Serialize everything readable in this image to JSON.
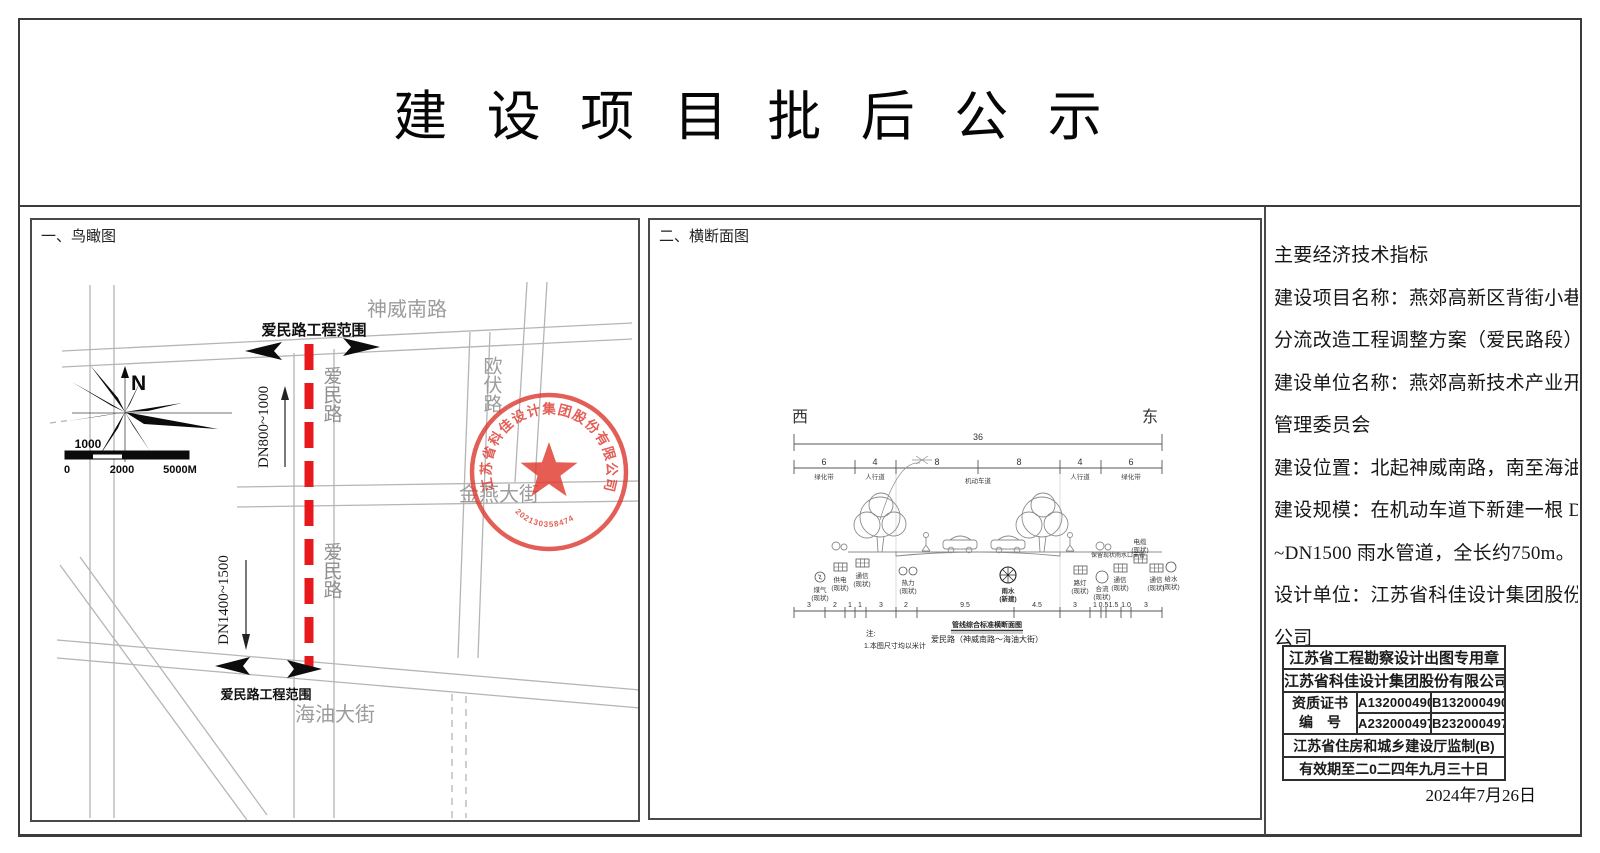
{
  "title": "建 设 项 目 批 后 公 示",
  "left_panel": {
    "heading": "一、鸟瞰图",
    "north": "N",
    "scale_top": "1000",
    "scale_0": "0",
    "scale_2000": "2000",
    "scale_5000": "5000M",
    "road_shenwei": "神威南路",
    "road_oufu": "欧伏路",
    "road_jinyan": "金燕大街",
    "road_haiyou": "海油大街",
    "road_aimin_north": "爱民路",
    "road_aimin_south": "爱民路",
    "scope_top": "爱民路工程范围",
    "scope_bottom": "爱民路工程范围",
    "pipe_north": "DN800~1000",
    "pipe_south": "DN1400~1500",
    "stamp_company": "江苏省科佳设计集团股份有限公司",
    "stamp_number": "202130358474"
  },
  "middle_panel": {
    "heading": "二、横断面图",
    "west": "西",
    "east": "东",
    "total": "36",
    "seg_dims": [
      "6",
      "4",
      "8",
      "8",
      "4",
      "6"
    ],
    "seg_labels": [
      "绿化带",
      "人行道",
      "机动车道",
      "人行道",
      "绿化带"
    ],
    "bottom_dims": [
      "3",
      "2",
      "1",
      "1",
      "3",
      "2",
      "9.5",
      "4.5",
      "3",
      "1",
      "0.5",
      "1.5",
      "1.0",
      "3"
    ],
    "utilities": [
      {
        "name": "煤气",
        "status": "(现状)"
      },
      {
        "name": "供电",
        "status": "(现状)"
      },
      {
        "name": "通信",
        "status": "(现状)"
      },
      {
        "name": "热力",
        "status": "(现状)"
      },
      {
        "name": "雨水",
        "status": "(新建)"
      },
      {
        "name": "路灯",
        "status": "(现状)"
      },
      {
        "name": "合流",
        "status": "(现状)"
      },
      {
        "name": "通信",
        "status": "(现状)"
      },
      {
        "name": "电缆",
        "status": "(现状)"
      },
      {
        "name": "通信",
        "status": "(现状)"
      },
      {
        "name": "给水",
        "status": "(现状)"
      }
    ],
    "keep_note": "保留现状雨水口支管",
    "caption_1": "管线综合标准横断面图",
    "caption_2": "爱民路（神威南路～海油大街）",
    "note_head": "注:",
    "note_1": "1.本图尺寸均以米计"
  },
  "right_panel": {
    "lines": [
      "主要经济技术指标",
      "建设项目名称：燕郊高新区背街小巷雨污",
      "分流改造工程调整方案（爱民路段）",
      "建设单位名称：燕郊高新技术产业开发区",
      "管理委员会",
      "建设位置：北起神威南路，南至海油大街",
      "建设规模：在机动车道下新建一根 DN800",
      "~DN1500 雨水管道，全长约750m。",
      "设计单位：江苏省科佳设计集团股份有限",
      "公司"
    ],
    "stamp": {
      "row1": "江苏省工程勘察设计出图专用章",
      "row2": "江苏省科佳设计集团股份有限公司",
      "cert_label_1": "资质证书",
      "cert_label_2": "编　号",
      "a1": "A132000490",
      "b1": "B132000490",
      "a2": "A232000497",
      "b2": "B232000497",
      "row5": "江苏省住房和城乡建设厅监制(B)",
      "row6": "有效期至二0二四年九月三十日"
    },
    "date": "2024年7月26日"
  }
}
